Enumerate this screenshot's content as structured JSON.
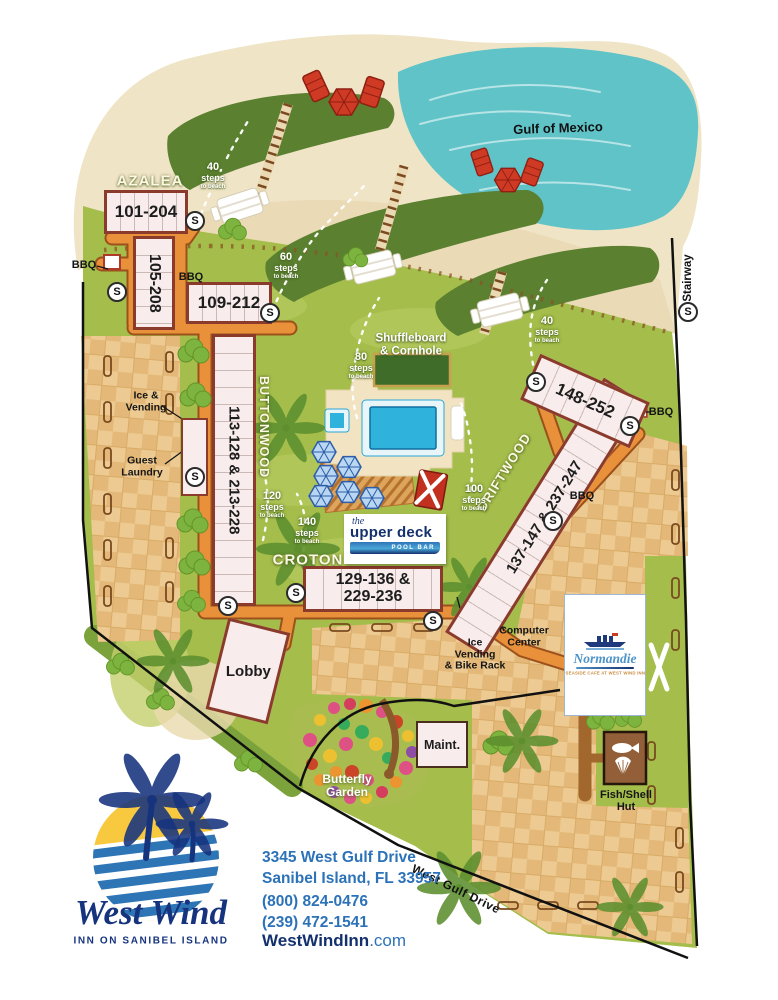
{
  "colors": {
    "brand_navy": "#16337e",
    "brand_blue": "#2c72b8",
    "sun_yellow": "#f8c93e",
    "road_orange": "#e8913a",
    "lawn_green": "#a4bd4b",
    "water_teal": "#5fc3c8",
    "building_outline": "#8a3b2b"
  },
  "labels": {
    "s": "S",
    "bbq": "BBQ",
    "stairway": "Stairway",
    "gulf": "Gulf of Mexico",
    "road": "West Gulf Drive"
  },
  "areas": {
    "azalea": "AZALEA",
    "buttonwood": "BUTTONWOOD",
    "croton": "CROTON",
    "driftwood": "DRIFTWOOD"
  },
  "buildings": {
    "b101": "101-204",
    "b105": "105-208",
    "b109": "109-212",
    "buttonwood_units": "113-128 & 213-228",
    "croton_line1": "129-136 &",
    "croton_line2": "229-236",
    "driftwood_units": "137-147 & 237-247",
    "b148": "148-252"
  },
  "facilities": {
    "lobby": "Lobby",
    "maint": "Maint.",
    "butterfly_line1": "Butterfly",
    "butterfly_line2": "Garden",
    "fish_line1": "Fish/Shell",
    "fish_line2": "Hut",
    "ice_line1": "Ice &",
    "ice_line2": "Vending",
    "laundry_line1": "Guest",
    "laundry_line2": "Laundry",
    "ivb_line1": "Ice",
    "ivb_line2": "Vending",
    "ivb_line3": "& Bike Rack",
    "comp_line1": "Computer",
    "comp_line2": "Center",
    "shuffle_line1": "Shuffleboard",
    "shuffle_line2": "& Cornhole"
  },
  "pool_bar": {
    "the": "the",
    "name": "upper deck",
    "sub": "POOL BAR"
  },
  "normandie": {
    "name": "Normandie",
    "tagline": "SEASIDE CAFE AT WEST WIND INN"
  },
  "steps": [
    {
      "count": "40",
      "word": "steps",
      "sub": "to beach"
    },
    {
      "count": "60",
      "word": "steps",
      "sub": "to beach"
    },
    {
      "count": "80",
      "word": "steps",
      "sub": "to beach"
    },
    {
      "count": "40",
      "word": "steps",
      "sub": "to beach"
    },
    {
      "count": "100",
      "word": "steps",
      "sub": "to beach"
    },
    {
      "count": "120",
      "word": "steps",
      "sub": "to beach"
    },
    {
      "count": "140",
      "word": "steps",
      "sub": "to beach"
    }
  ],
  "footer": {
    "address1": "3345 West Gulf Drive",
    "address2": "Sanibel Island, FL 33957",
    "phone1": "(800) 824-0476",
    "phone2": "(239) 472-1541",
    "site_bold": "WestWindInn",
    "site_rest": ".com",
    "logo_script": "West Wind",
    "logo_sub": "INN ON SANIBEL ISLAND"
  }
}
